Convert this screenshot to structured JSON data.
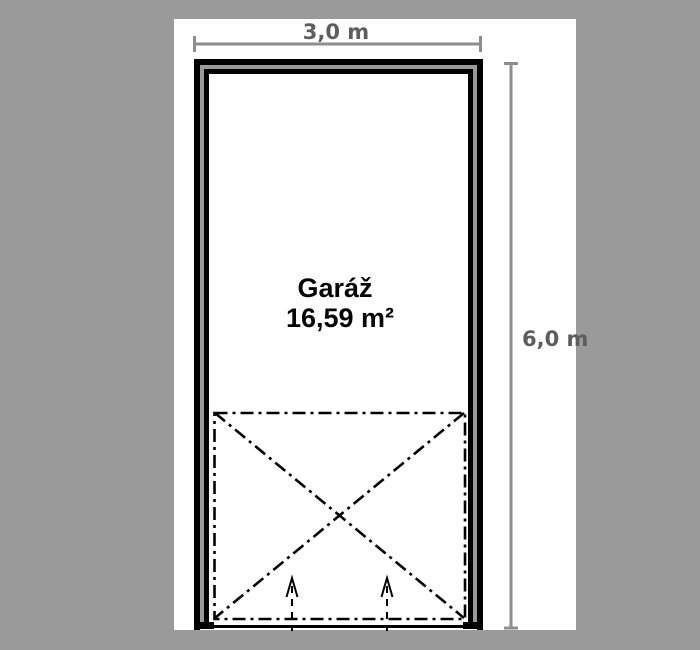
{
  "plan": {
    "room_label": "Garáž",
    "room_area": "16,59 m²",
    "dimensions": {
      "width_label": "3,0 m",
      "height_label": "6,0 m"
    }
  },
  "colors": {
    "page_background": "#9a9a9a",
    "canvas_background": "#ffffff",
    "wall_line": "#000000",
    "wall_core": "#9a9a9a",
    "dimension_line": "#8e8e8e",
    "dimension_text": "#5d5d5d",
    "room_text": "#050505"
  }
}
